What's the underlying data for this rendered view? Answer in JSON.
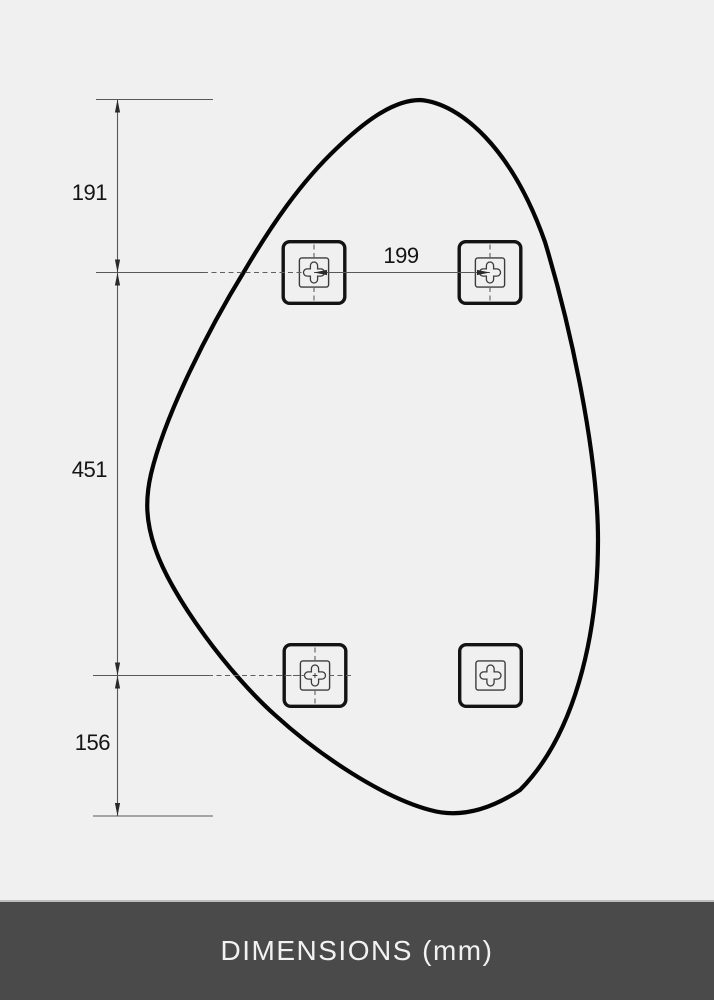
{
  "page": {
    "background_color": "#f0f0f0"
  },
  "diagram": {
    "description": "Dimension drawing of an organic pebble-shaped mirror with four square wall-mount brackets",
    "unit": "mm",
    "labels": {
      "top_edge_to_upper_brackets": "191",
      "upper_bracket_spacing": "199",
      "upper_to_lower_brackets": "451",
      "lower_brackets_to_bottom_edge": "156"
    },
    "colors": {
      "outline": "#050505",
      "dimension_line": "#585858",
      "bracket_stroke": "#131313"
    }
  },
  "footer": {
    "title": "DIMENSIONS (mm)",
    "background_color": "#4a4a4a",
    "text_color": "#f2f2f2"
  }
}
